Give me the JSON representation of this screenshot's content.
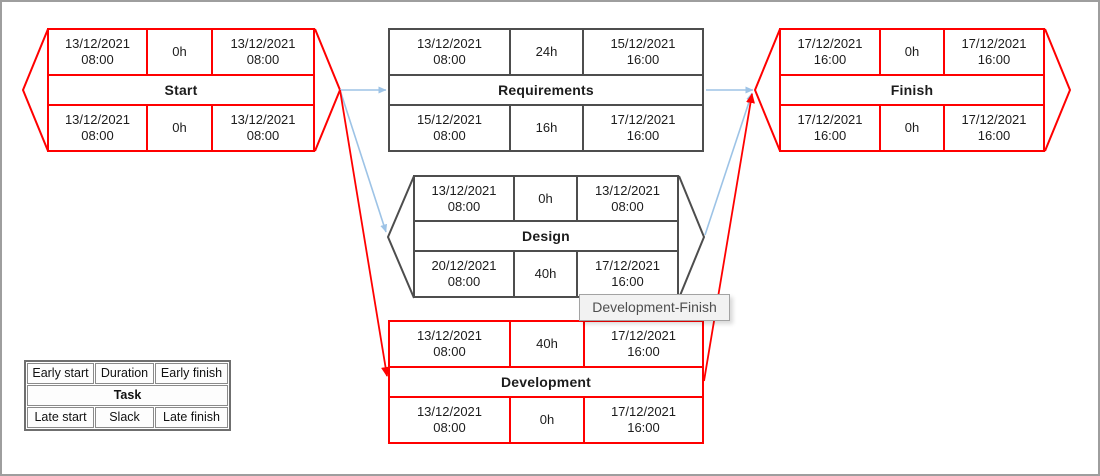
{
  "colors": {
    "critical": "#ff0000",
    "normal": "#4d4d4d",
    "edge_blue": "#9dc3e6",
    "edge_red": "#ff0000",
    "text": "#1c1c1c",
    "frame_border": "#9e9e9e",
    "legend_border": "#6f6f6f",
    "tooltip_bg": "#f2f2f2",
    "tooltip_border": "#a3a3a3",
    "tooltip_text": "#4f4f4f"
  },
  "nodes": [
    {
      "name": "Start",
      "shape": "hexagon",
      "critical": true,
      "early_start": {
        "date": "13/12/2021",
        "time": "08:00"
      },
      "duration": "0h",
      "early_finish": {
        "date": "13/12/2021",
        "time": "08:00"
      },
      "late_start": {
        "date": "13/12/2021",
        "time": "08:00"
      },
      "slack": "0h",
      "late_finish": {
        "date": "13/12/2021",
        "time": "08:00"
      }
    },
    {
      "name": "Requirements",
      "shape": "rect",
      "critical": false,
      "early_start": {
        "date": "13/12/2021",
        "time": "08:00"
      },
      "duration": "24h",
      "early_finish": {
        "date": "15/12/2021",
        "time": "16:00"
      },
      "late_start": {
        "date": "15/12/2021",
        "time": "08:00"
      },
      "slack": "16h",
      "late_finish": {
        "date": "17/12/2021",
        "time": "16:00"
      }
    },
    {
      "name": "Design",
      "shape": "hexagon",
      "critical": false,
      "early_start": {
        "date": "13/12/2021",
        "time": "08:00"
      },
      "duration": "0h",
      "early_finish": {
        "date": "13/12/2021",
        "time": "08:00"
      },
      "late_start": {
        "date": "20/12/2021",
        "time": "08:00"
      },
      "slack": "40h",
      "late_finish": {
        "date": "17/12/2021",
        "time": "16:00"
      }
    },
    {
      "name": "Development",
      "shape": "rect",
      "critical": true,
      "early_start": {
        "date": "13/12/2021",
        "time": "08:00"
      },
      "duration": "40h",
      "early_finish": {
        "date": "17/12/2021",
        "time": "16:00"
      },
      "late_start": {
        "date": "13/12/2021",
        "time": "08:00"
      },
      "slack": "0h",
      "late_finish": {
        "date": "17/12/2021",
        "time": "16:00"
      }
    },
    {
      "name": "Finish",
      "shape": "hexagon",
      "critical": true,
      "early_start": {
        "date": "17/12/2021",
        "time": "16:00"
      },
      "duration": "0h",
      "early_finish": {
        "date": "17/12/2021",
        "time": "16:00"
      },
      "late_start": {
        "date": "17/12/2021",
        "time": "16:00"
      },
      "slack": "0h",
      "late_finish": {
        "date": "17/12/2021",
        "time": "16:00"
      }
    }
  ],
  "edges": [
    {
      "from": "Start",
      "to": "Requirements",
      "critical": false
    },
    {
      "from": "Start",
      "to": "Design",
      "critical": false
    },
    {
      "from": "Start",
      "to": "Development",
      "critical": true
    },
    {
      "from": "Requirements",
      "to": "Finish",
      "critical": false
    },
    {
      "from": "Design",
      "to": "Finish",
      "critical": false
    },
    {
      "from": "Development",
      "to": "Finish",
      "critical": true
    }
  ],
  "legend": {
    "early_start": "Early start",
    "duration": "Duration",
    "early_finish": "Early finish",
    "task": "Task",
    "late_start": "Late start",
    "slack": "Slack",
    "late_finish": "Late finish"
  },
  "tooltip": {
    "text": "Development-Finish"
  }
}
